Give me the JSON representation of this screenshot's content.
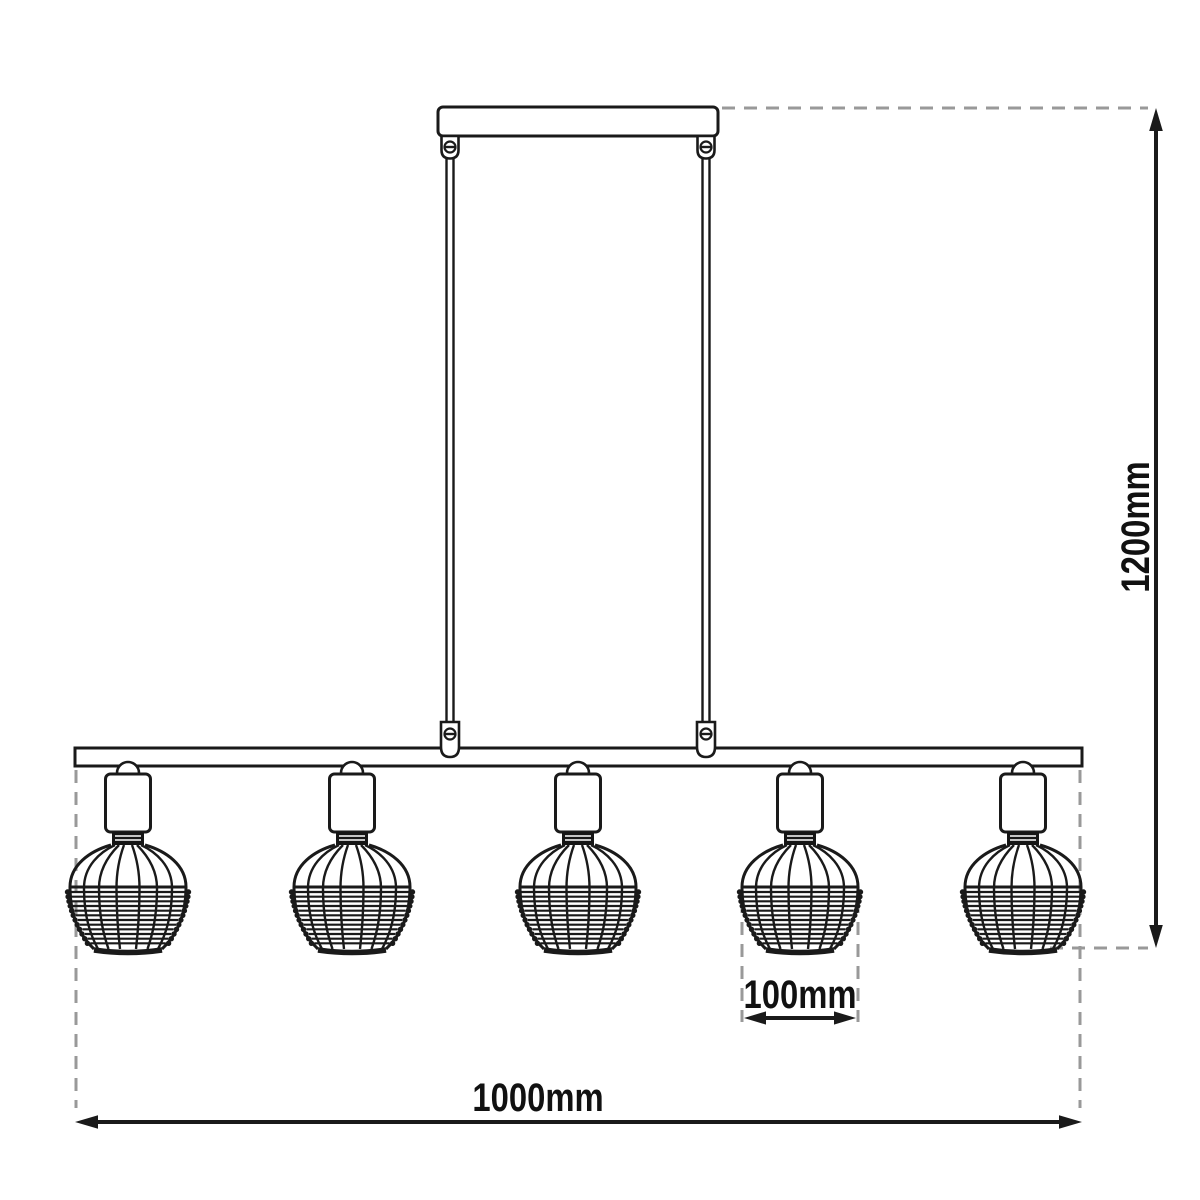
{
  "drawing": {
    "type": "pendant-lamp-technical-dimension-diagram",
    "shade_count": 5,
    "labels": {
      "height": "1200mm",
      "width": "1000mm",
      "shade_width": "100mm"
    },
    "colors": {
      "line": "#1a1a1a",
      "guide_dashed": "#999999",
      "background": "#ffffff"
    }
  },
  "shade_centers": [
    128,
    352,
    578,
    800,
    1023
  ]
}
